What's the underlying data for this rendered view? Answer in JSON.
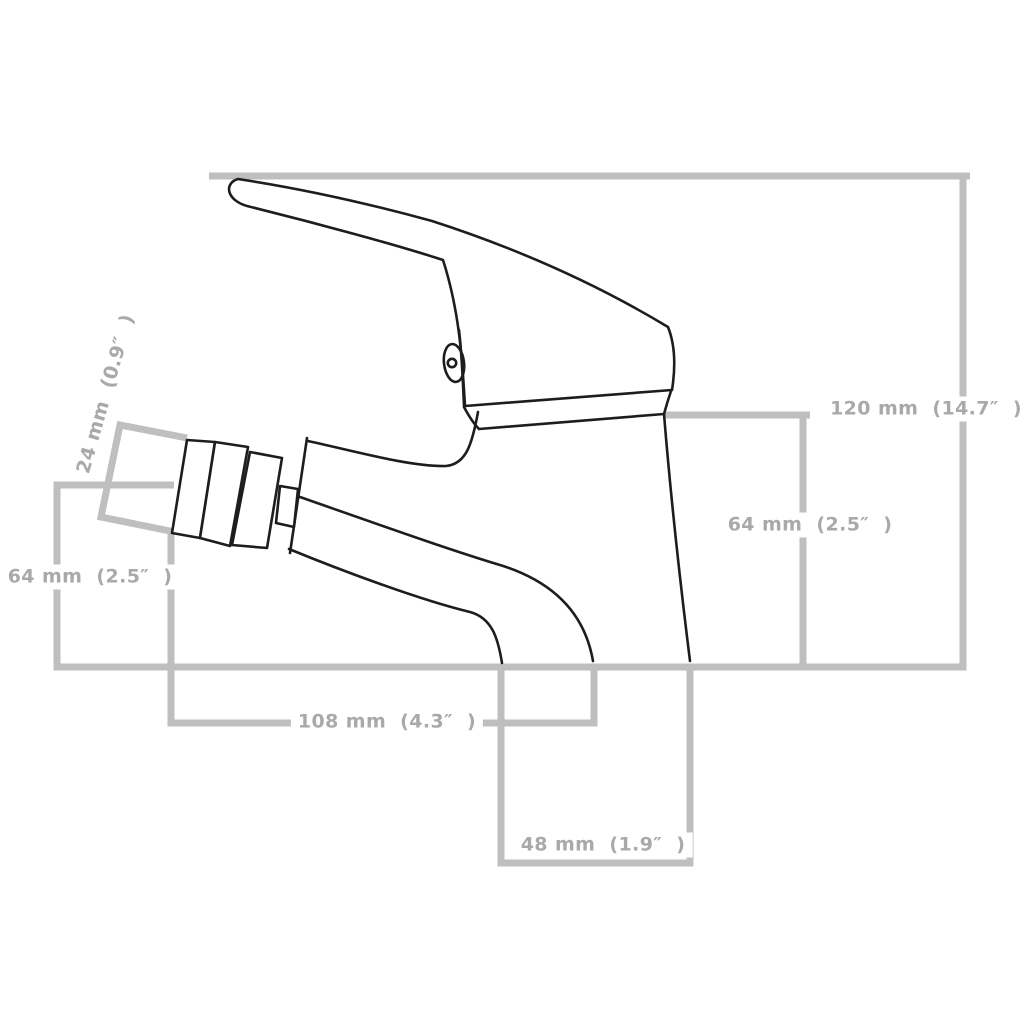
{
  "diagram": {
    "kind": "product-dimension-line-drawing",
    "labels": {
      "total_height": "120 mm  (14.7″  )",
      "body_height": "64 mm  (2.5″  )",
      "spout_height": "64 mm  (2.5″  )",
      "nozzle_diameter": "24 mm  (0.9″  )",
      "overall_depth": "108 mm  (4.3″  )",
      "base_width": "48 mm  (1.9″  )"
    },
    "values": {
      "total_height_mm": 120,
      "total_height_in": 14.7,
      "body_height_mm": 64,
      "body_height_in": 2.5,
      "spout_height_mm": 64,
      "spout_height_in": 2.5,
      "nozzle_diameter_mm": 24,
      "nozzle_diameter_in": 0.9,
      "overall_depth_mm": 108,
      "overall_depth_in": 4.3,
      "base_width_mm": 48,
      "base_width_in": 1.9
    },
    "colors": {
      "dimension_line": "#bfbfbf",
      "label_text": "#a9a9a9",
      "drawing_outline": "#1d1d1d",
      "background": "#ffffff"
    }
  }
}
